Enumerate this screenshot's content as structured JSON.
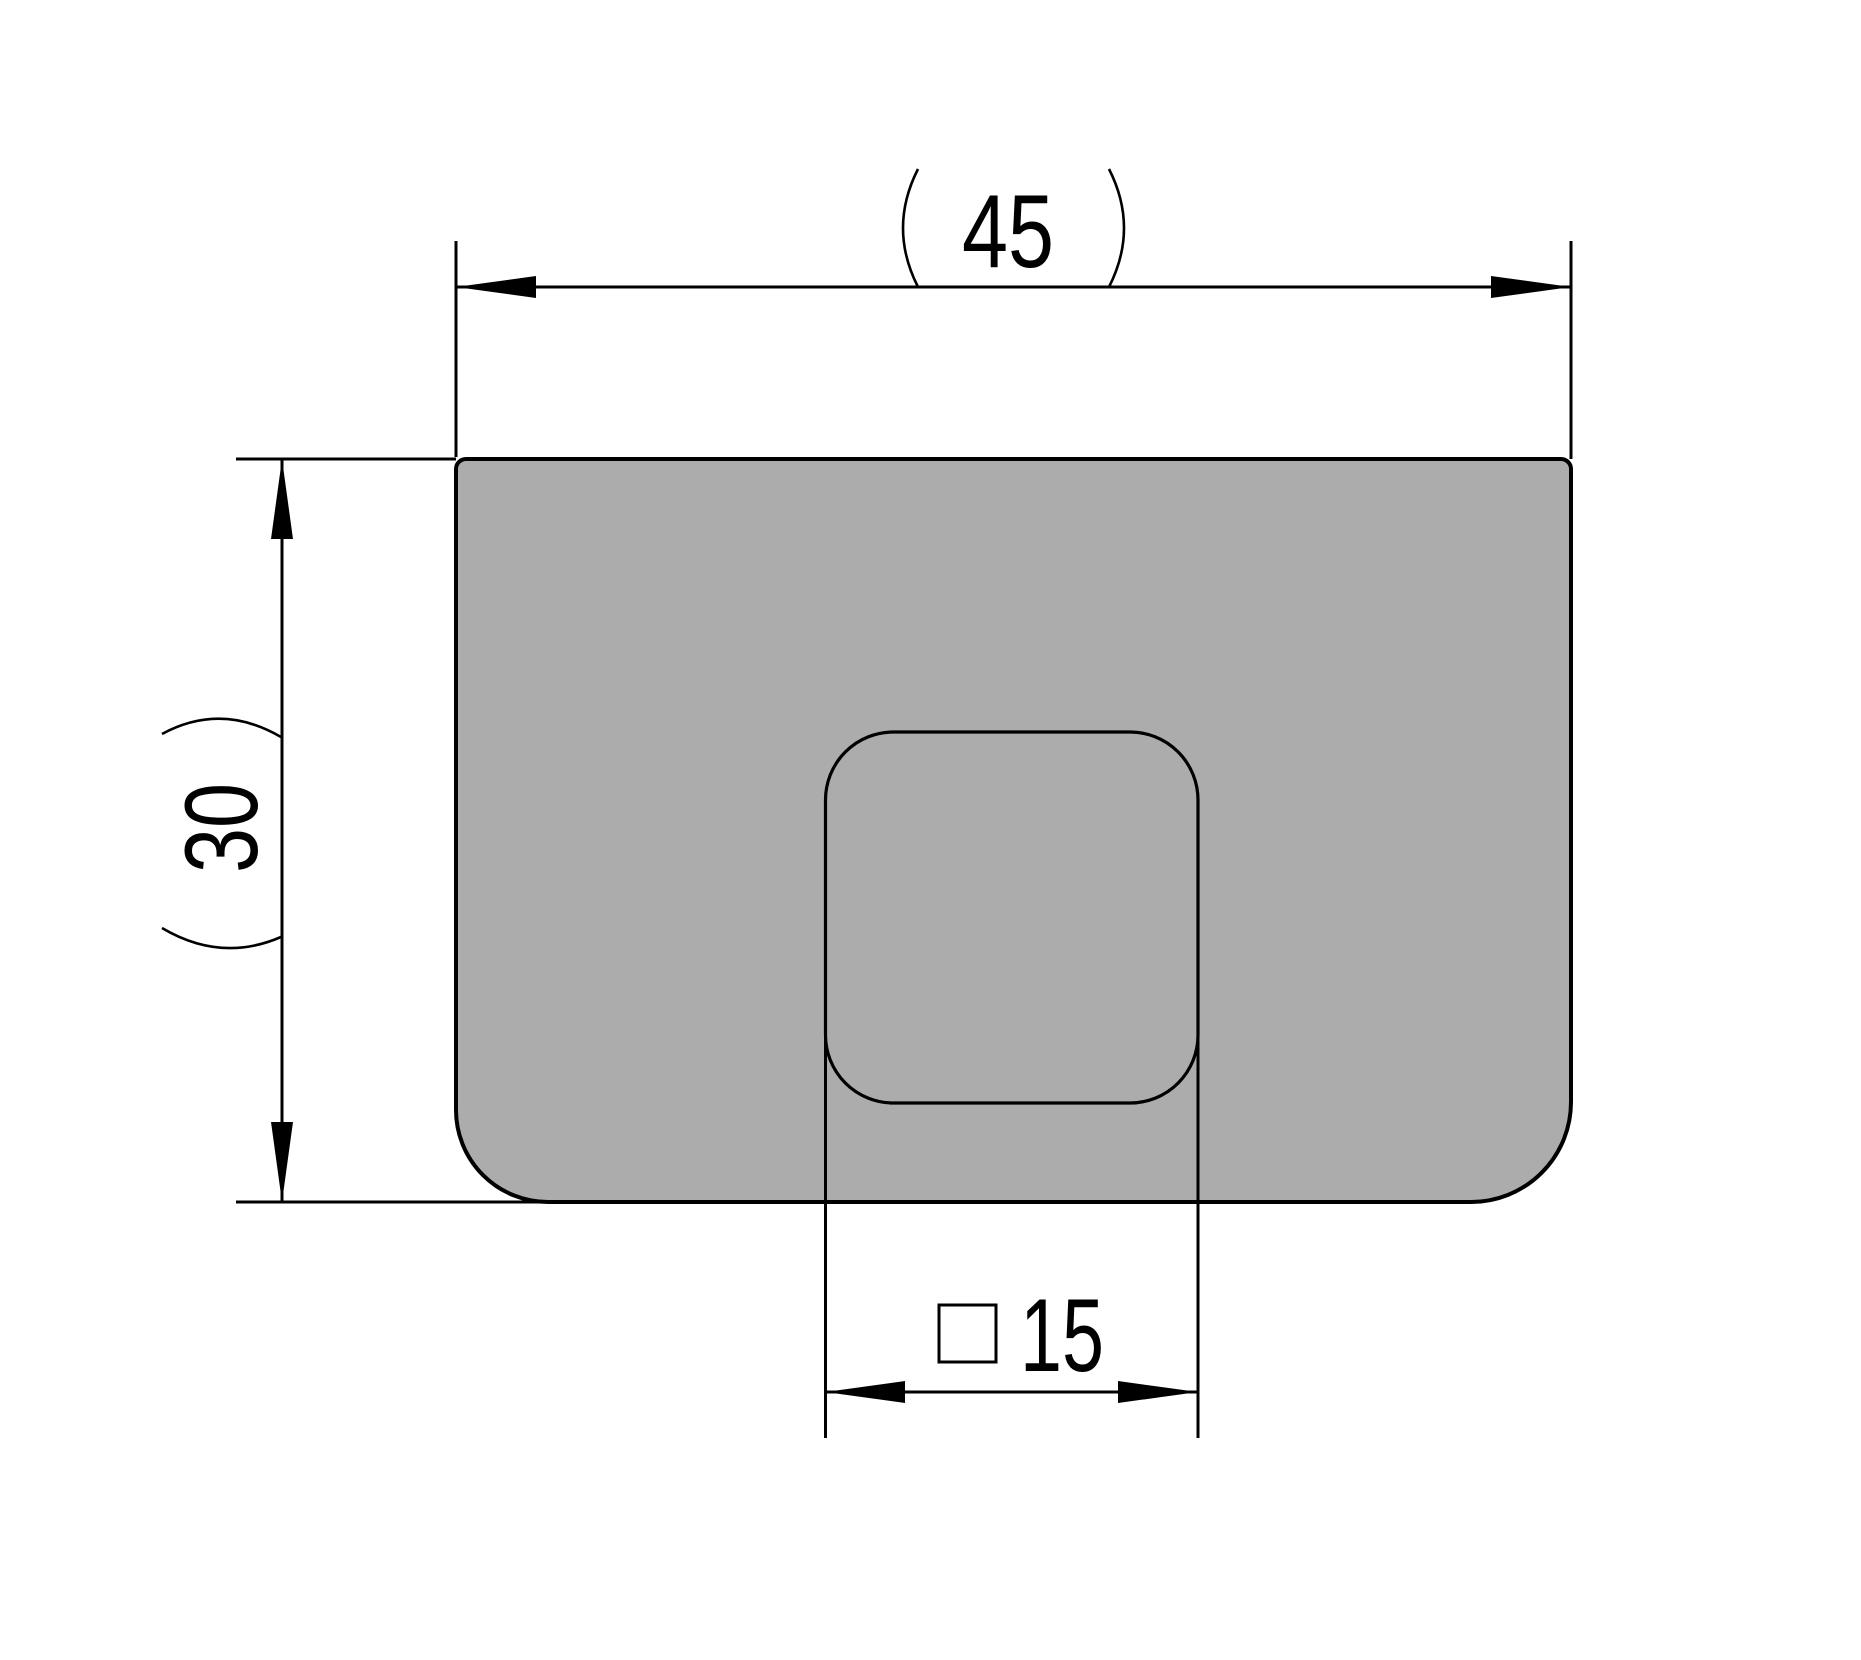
{
  "drawing": {
    "type": "technical-dimension-drawing",
    "background_color": "#ffffff",
    "line_color": "#000000",
    "part": {
      "name": "plate-with-square-pocket",
      "fill_color": "#ACACAC"
    },
    "dimensions": {
      "width": {
        "value": "45",
        "parenthesized": true,
        "orientation": "horizontal",
        "position": "top"
      },
      "height": {
        "value": "30",
        "parenthesized": true,
        "orientation": "vertical",
        "position": "left"
      },
      "pocket": {
        "value": "15",
        "square_symbol": true,
        "orientation": "horizontal",
        "position": "bottom"
      }
    }
  }
}
